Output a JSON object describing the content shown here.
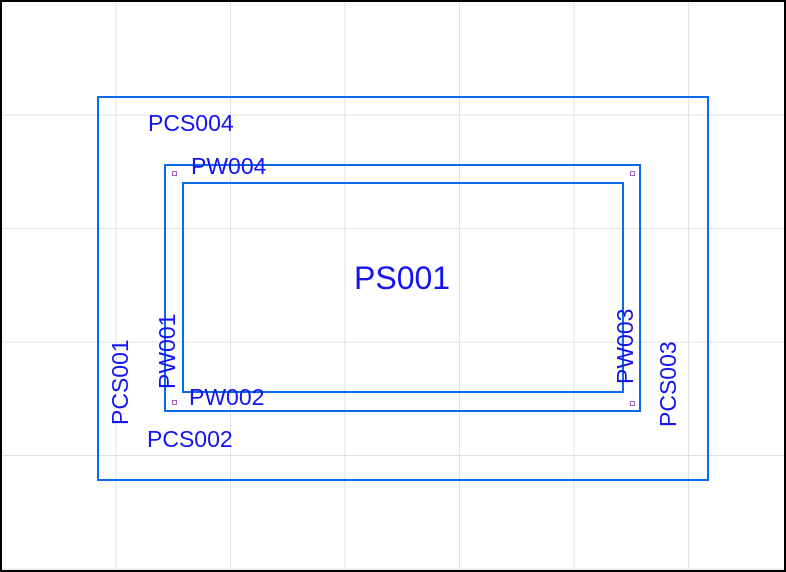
{
  "drawing": {
    "labels": {
      "pcs004": "PCS004",
      "pw004": "PW004",
      "ps001": "PS001",
      "pcs001": "PCS001",
      "pw001": "PW001",
      "pw002": "PW002",
      "pcs002": "PCS002",
      "pw003": "PW003",
      "pcs003": "PCS003"
    },
    "colors": {
      "line": "#0a6ced",
      "text": "#1414f0",
      "grid": "#e0e1e6",
      "marker": "#9c64c8",
      "background": "#ffffff",
      "frame": "#000000"
    }
  }
}
